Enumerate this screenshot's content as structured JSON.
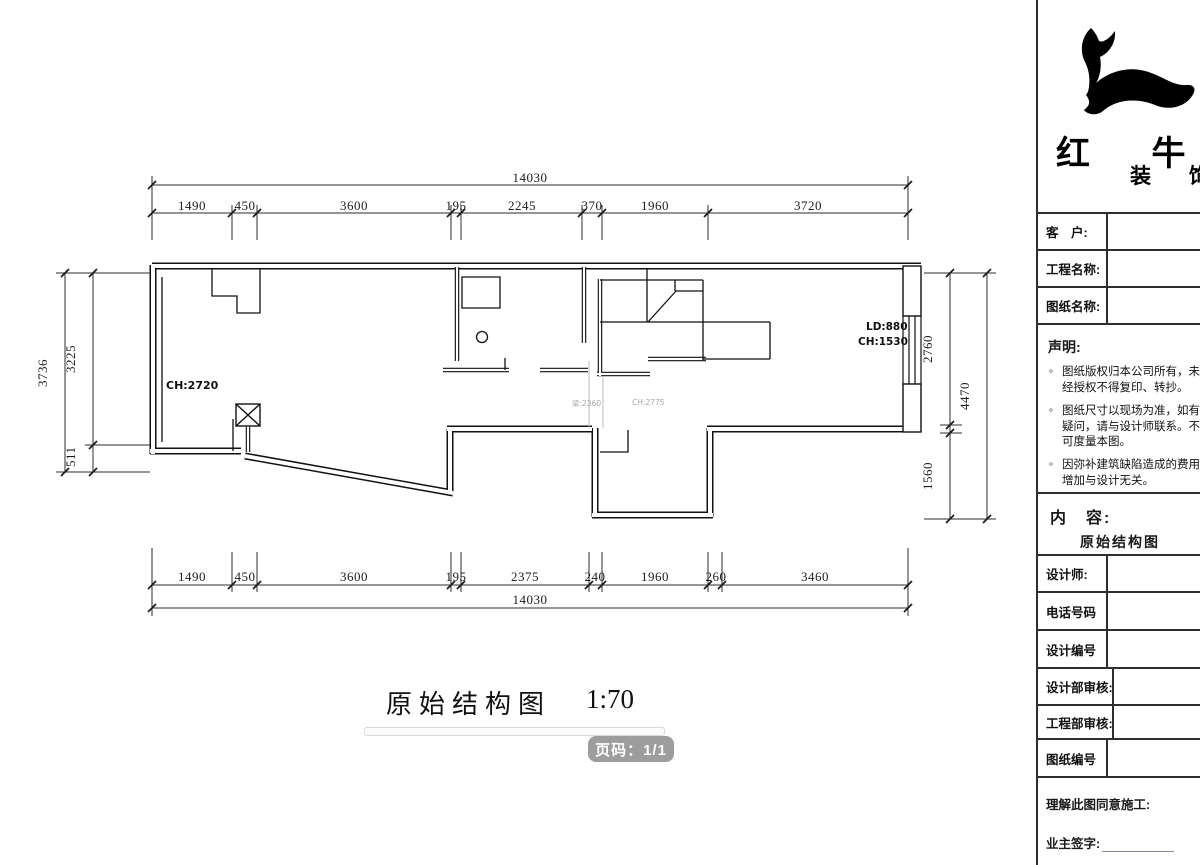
{
  "drawing": {
    "title": "原始结构图",
    "scale": "1:70",
    "page_badge": "页码：1/1",
    "labels": {
      "room_ch": "CH:2720",
      "window_ld": "LD:880",
      "window_ch": "CH:1530",
      "beam": "梁:2360",
      "beam_ch": "CH:2775"
    }
  },
  "dims": {
    "top_total": "14030",
    "top_segments": [
      "1490",
      "450",
      "3600",
      "195",
      "2245",
      "370",
      "1960",
      "3720"
    ],
    "bottom_segments": [
      "1490",
      "450",
      "3600",
      "195",
      "2375",
      "240",
      "1960",
      "260",
      "3460"
    ],
    "bottom_total": "14030",
    "left": {
      "outer": "3736",
      "upper": "3225",
      "lower": "511"
    },
    "right": {
      "upper": "2760",
      "outer": "4470",
      "lower": "1560"
    }
  },
  "title_block": {
    "brand_large": "红 牛",
    "brand_small": "装 饰",
    "customer_label": "客　户:",
    "project_label": "工程名称:",
    "drawing_name_label": "图纸名称:",
    "statement_title": "声明:",
    "statement_items": [
      "图纸版权归本公司所有，未经授权不得复印、转抄。",
      "图纸尺寸以现场为准，如有疑问，请与设计师联系。不可度量本图。",
      "因弥补建筑缺陷造成的费用增加与设计无关。"
    ],
    "content_label": "内　容:",
    "content_value": "原始结构图",
    "designer_label": "设计师:",
    "phone_label": "电话号码",
    "design_no_label": "设计编号",
    "design_review_label": "设计部审核:",
    "eng_review_label": "工程部审核:",
    "drawing_no_label": "图纸编号",
    "agreement_label": "理解此图同意施工:",
    "owner_sign_label": "业主签字:"
  }
}
